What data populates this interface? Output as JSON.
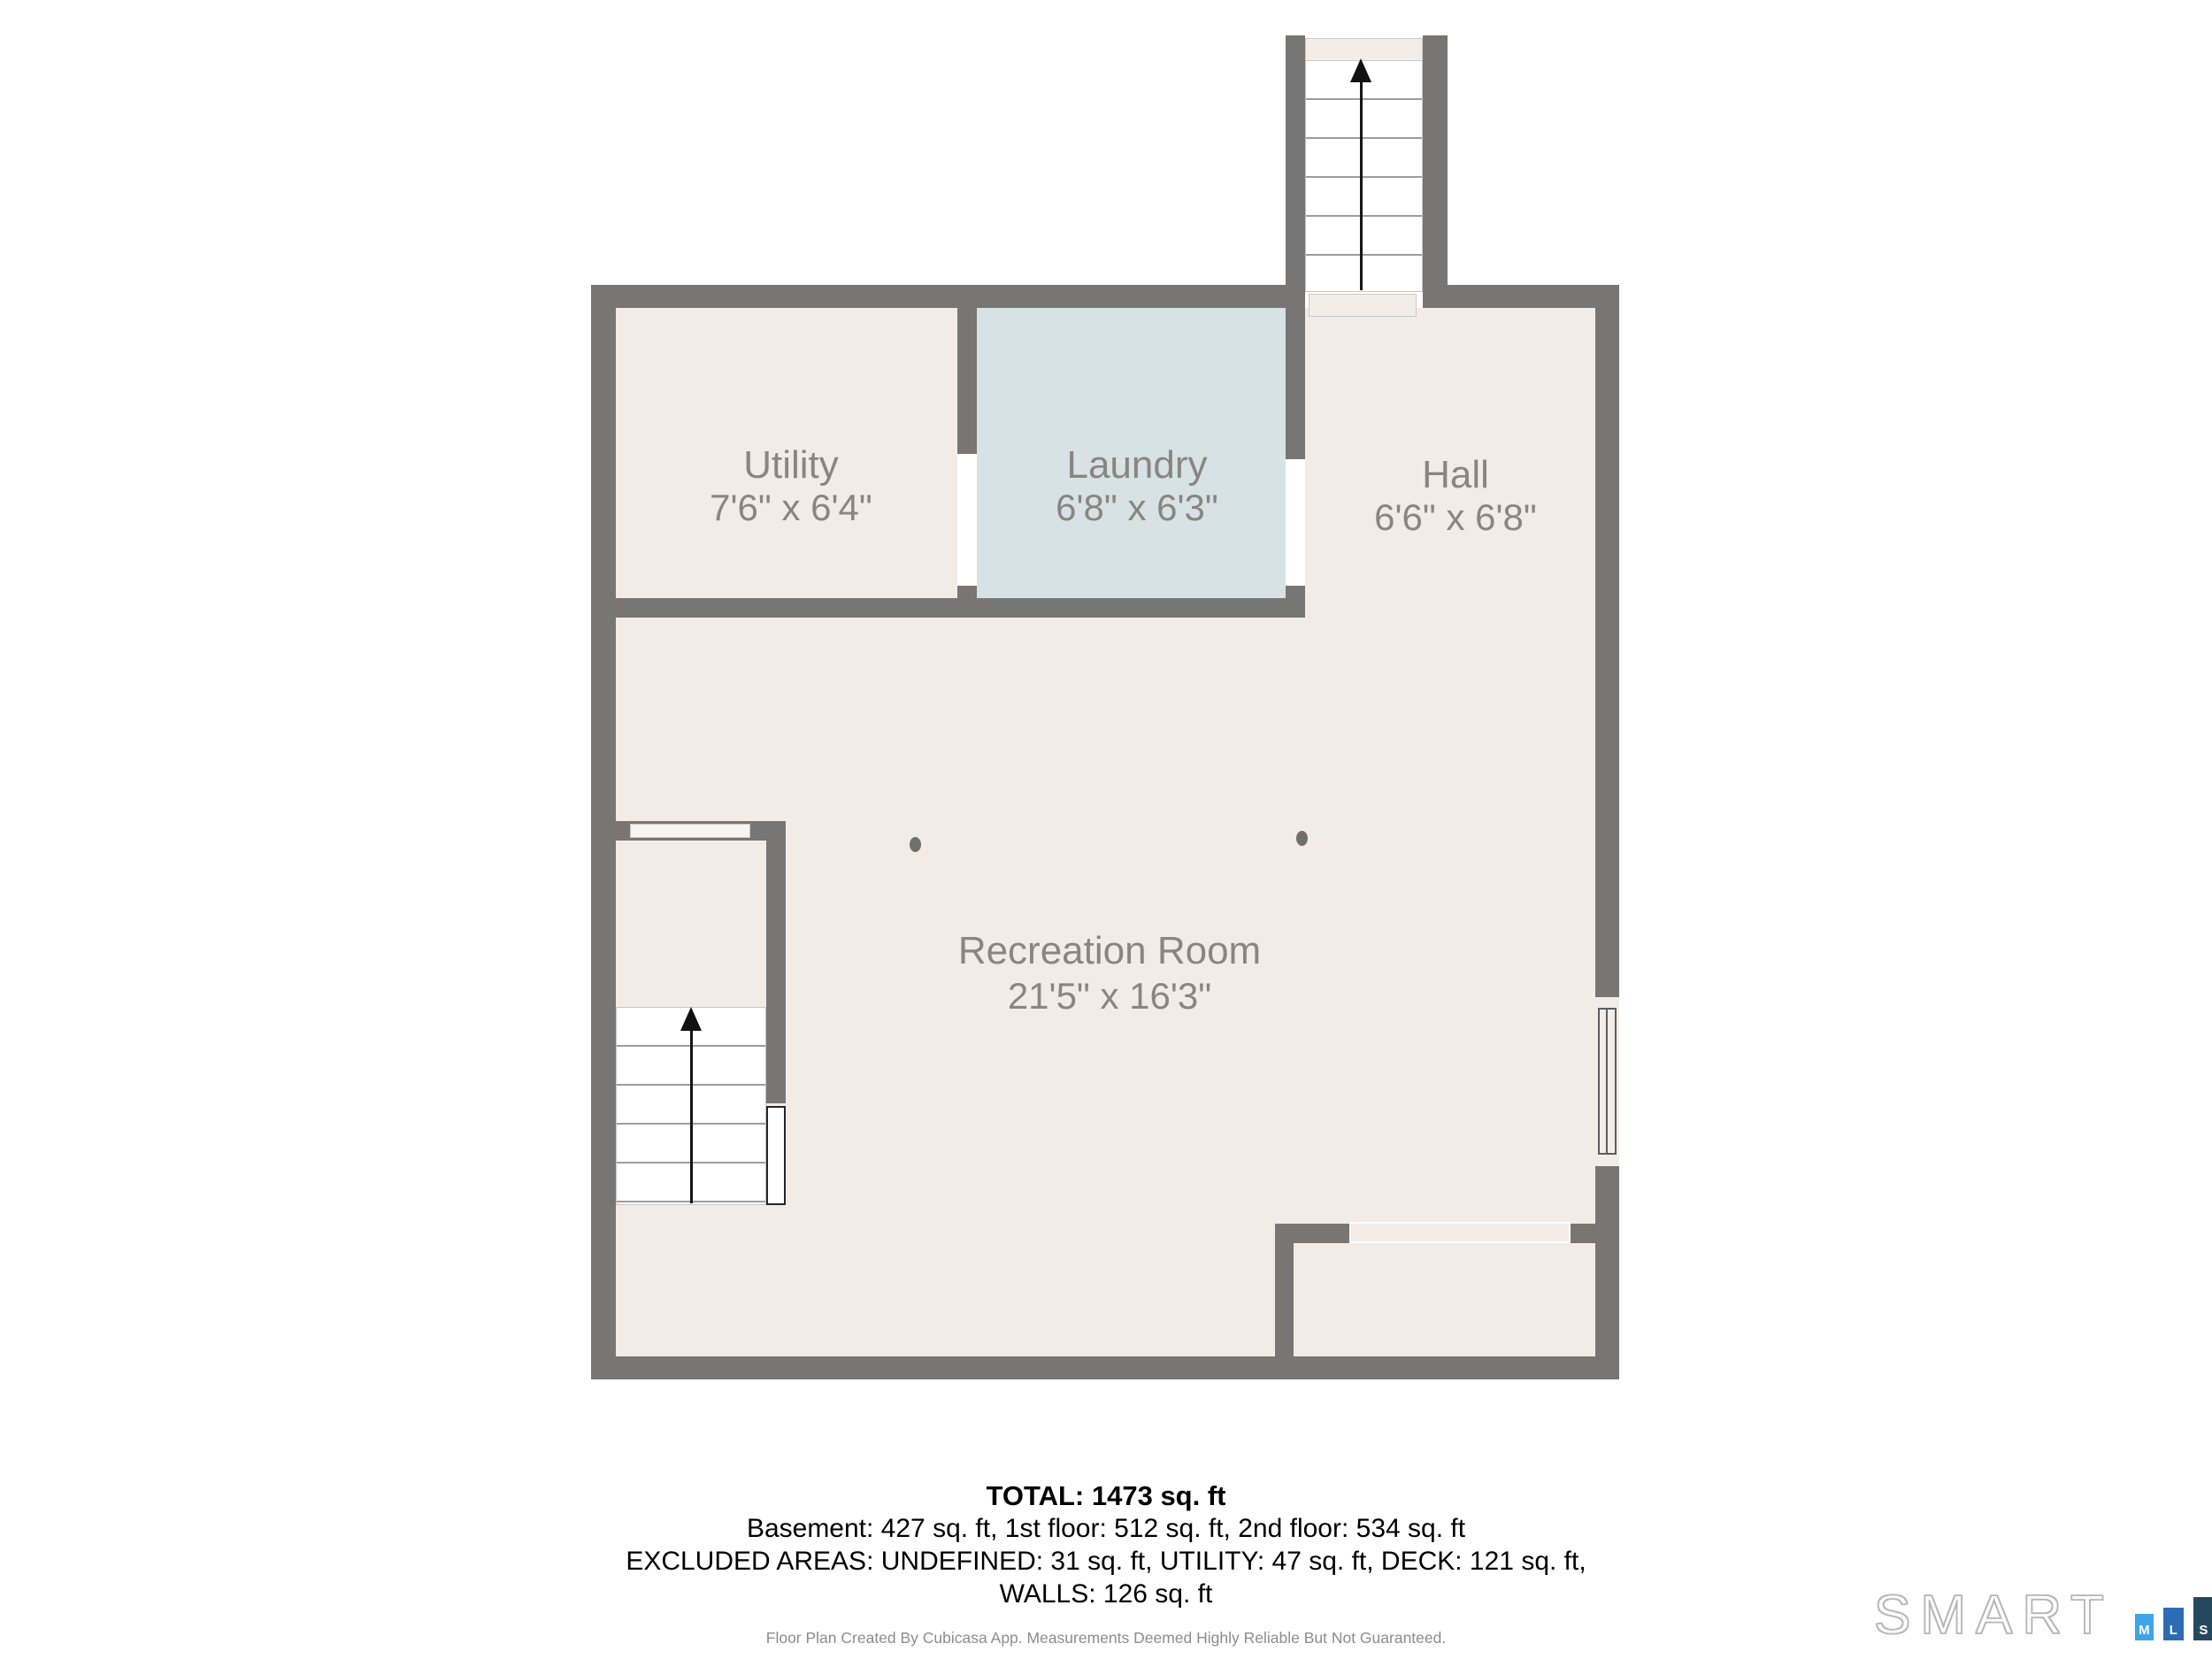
{
  "floorplan": {
    "rooms": [
      {
        "id": "utility",
        "label": "Utility",
        "dims": "7'6\" x 6'4\""
      },
      {
        "id": "laundry",
        "label": "Laundry",
        "dims": "6'8\" x 6'3\""
      },
      {
        "id": "hall",
        "label": "Hall",
        "dims": "6'6\" x 6'8\""
      },
      {
        "id": "recreation-room",
        "label": "Recreation Room",
        "dims": "21'5\" x 16'3\""
      }
    ],
    "colors": {
      "wall": "#777675",
      "room_fill": "#f3ece6",
      "laundry_fill": "#d6e2e3"
    }
  },
  "summary": {
    "total": "TOTAL: 1473 sq. ft",
    "floors": "Basement: 427 sq. ft, 1st floor: 512 sq. ft, 2nd floor: 534 sq. ft",
    "excluded": "EXCLUDED AREAS: UNDEFINED: 31 sq. ft, UTILITY: 47 sq. ft, DECK: 121 sq. ft,",
    "walls": "WALLS: 126 sq. ft"
  },
  "footer": {
    "disclaimer": "Floor Plan Created By Cubicasa App. Measurements Deemed Highly Reliable But Not Guaranteed."
  },
  "logo": {
    "brand": "SMART",
    "mls_letters": [
      "M",
      "L",
      "S"
    ],
    "colors": {
      "m": "#3fa3e8",
      "l": "#2d6cb4",
      "s": "#26485f"
    }
  }
}
